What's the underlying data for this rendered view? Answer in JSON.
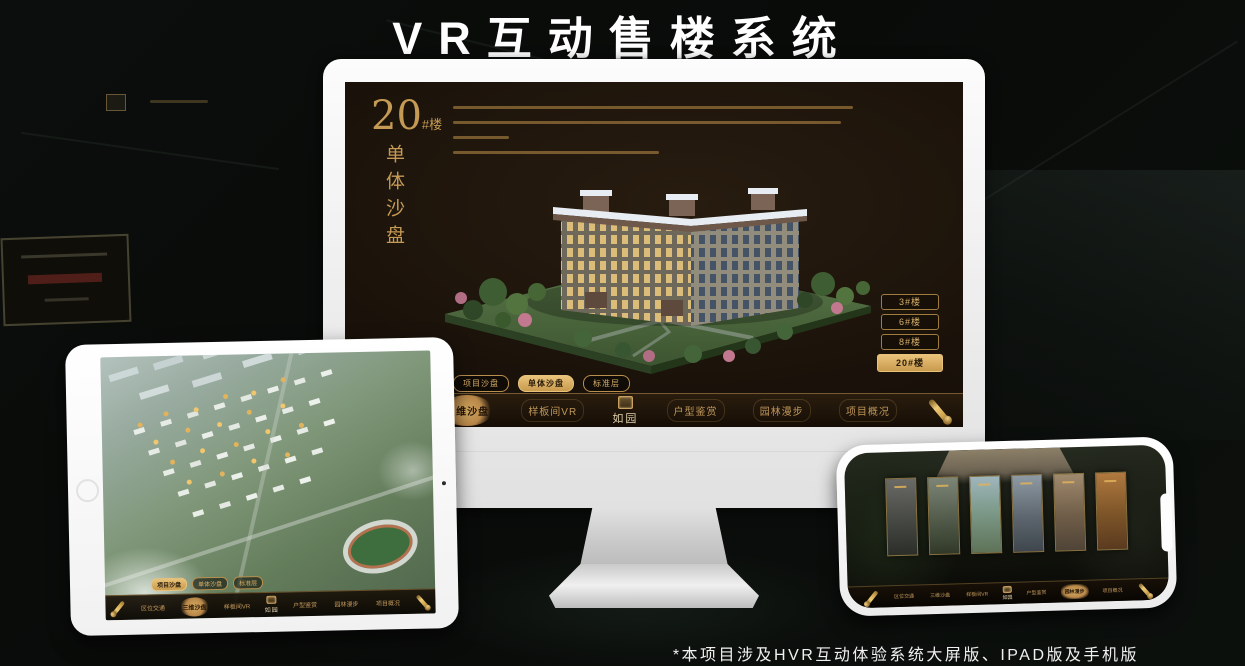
{
  "page": {
    "title": "VR互动售楼系统",
    "footnote": "*本项目涉及HVR互动体验系统大屏版、IPAD版及手机版"
  },
  "colors": {
    "gold": "#c59a55",
    "gold_bright": "#e9c37a",
    "screen_bg": "#1a120a",
    "background": "#0a0c0a",
    "title_text": "#ffffff"
  },
  "monitor": {
    "panel_title": {
      "number": "20",
      "suffix": "#楼",
      "vertical": "单体沙盘"
    },
    "floor_buttons": [
      {
        "label": "3#楼",
        "active": false
      },
      {
        "label": "6#楼",
        "active": false
      },
      {
        "label": "8#楼",
        "active": false
      },
      {
        "label": "20#楼",
        "active": true
      }
    ],
    "sub_tabs": [
      {
        "label": "项目沙盘",
        "active": false
      },
      {
        "label": "单体沙盘",
        "active": true
      },
      {
        "label": "标准层",
        "active": false
      }
    ],
    "nav_items": [
      {
        "label": "区位交通",
        "active": false
      },
      {
        "label": "三维沙盘",
        "active": true
      },
      {
        "label": "样板间VR",
        "active": false
      },
      {
        "label": "户型鉴赏",
        "active": false
      },
      {
        "label": "园林漫步",
        "active": false
      },
      {
        "label": "项目概况",
        "active": false
      }
    ],
    "logo": "如园",
    "icons": {
      "scroll": "scroll-handle-icon"
    }
  },
  "tablet": {
    "sub_tabs": [
      {
        "label": "项目沙盘",
        "active": true
      },
      {
        "label": "单体沙盘",
        "active": false
      },
      {
        "label": "标准层",
        "active": false
      }
    ],
    "nav_items": [
      {
        "label": "区位交通",
        "active": false
      },
      {
        "label": "三维沙盘",
        "active": true
      },
      {
        "label": "样板间VR",
        "active": false
      },
      {
        "label": "户型鉴赏",
        "active": false
      },
      {
        "label": "园林漫步",
        "active": false
      },
      {
        "label": "项目概况",
        "active": false
      }
    ],
    "logo": "如园"
  },
  "phone": {
    "nav_items": [
      {
        "label": "区位交通",
        "active": false
      },
      {
        "label": "三维沙盘",
        "active": false
      },
      {
        "label": "样板间VR",
        "active": false
      },
      {
        "label": "户型鉴赏",
        "active": false
      },
      {
        "label": "园林漫步",
        "active": true
      },
      {
        "label": "项目概况",
        "active": false
      }
    ],
    "logo": "如园"
  }
}
